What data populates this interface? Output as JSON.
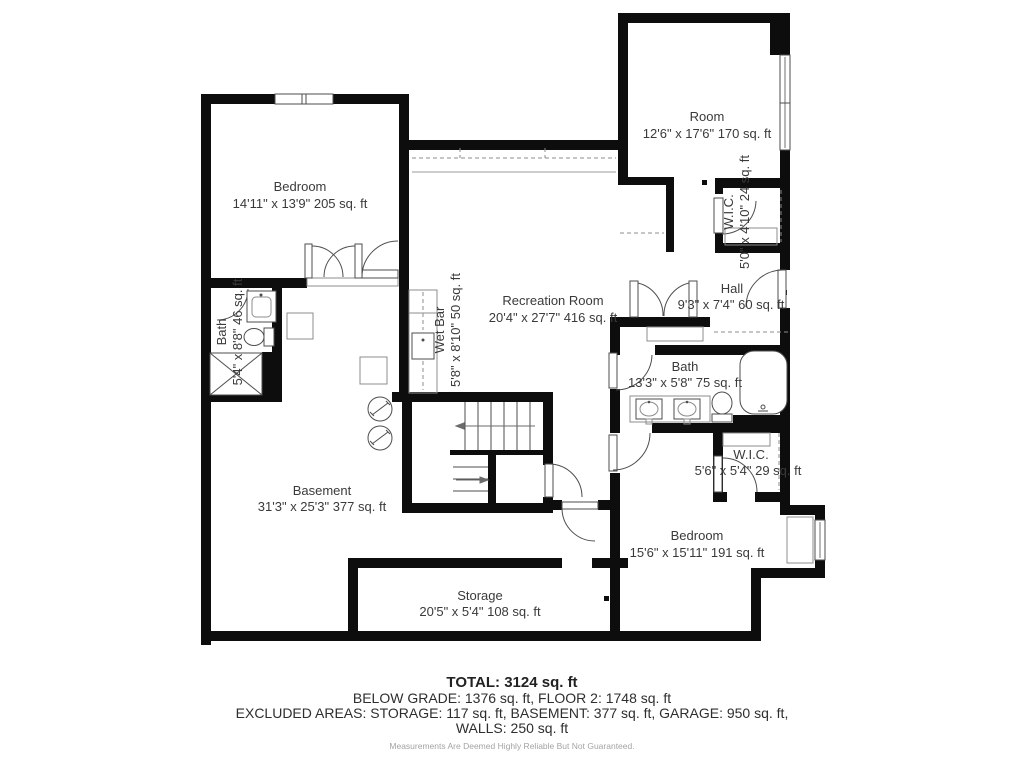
{
  "floor_plan": {
    "rooms": {
      "bedroom_tl": {
        "name": "Bedroom",
        "dims": "14'11\" x 13'9\" 205 sq. ft"
      },
      "room_tr": {
        "name": "Room",
        "dims": "12'6\" x 17'6\" 170 sq. ft"
      },
      "wic_top": {
        "name": "W.I.C.",
        "dims": "5'0\" x 4'10\" 24 sq. ft"
      },
      "hall": {
        "name": "Hall",
        "dims": "9'3\" x 7'4\" 60 sq. ft"
      },
      "recreation": {
        "name": "Recreation Room",
        "dims": "20'4\" x 27'7\" 416 sq. ft"
      },
      "wet_bar": {
        "name": "Wet Bar",
        "dims": "5'8\" x 8'10\" 50 sq. ft"
      },
      "bath_left": {
        "name": "Bath",
        "dims": "5'4\" x 8'8\" 46 sq. ft"
      },
      "bath_main": {
        "name": "Bath",
        "dims": "13'3\" x 5'8\" 75 sq. ft"
      },
      "wic_bottom": {
        "name": "W.I.C.",
        "dims": "5'6\" x 5'4\" 29 sq. ft"
      },
      "bedroom_br": {
        "name": "Bedroom",
        "dims": "15'6\" x 15'11\" 191 sq. ft"
      },
      "basement": {
        "name": "Basement",
        "dims": "31'3\" x 25'3\" 377 sq. ft"
      },
      "storage": {
        "name": "Storage",
        "dims": "20'5\" x 5'4\" 108 sq. ft"
      }
    },
    "summary": {
      "total": "TOTAL: 3124 sq. ft",
      "line2": "BELOW GRADE: 1376 sq. ft, FLOOR 2: 1748 sq. ft",
      "line3": "EXCLUDED AREAS: STORAGE: 117 sq. ft, BASEMENT: 377 sq. ft, GARAGE: 950 sq. ft,",
      "line4": "WALLS: 250 sq. ft",
      "disclaimer": "Measurements Are Deemed Highly Reliable But Not Guaranteed."
    },
    "colors": {
      "wall": "#0d0d0d",
      "text": "#3a3a3a",
      "fixture": "#4d4d4d",
      "disclaimer": "#a3a3a3"
    }
  }
}
